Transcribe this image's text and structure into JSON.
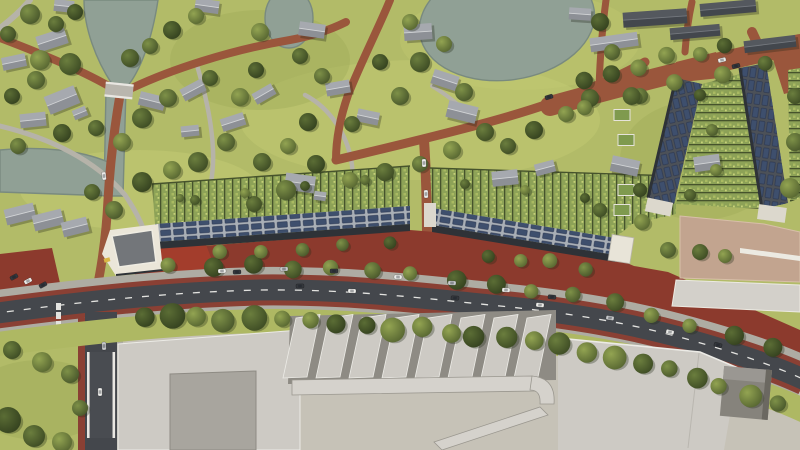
{
  "meta": {
    "description": "aerial-render-of-residential-masterplan",
    "canvas": {
      "width": 800,
      "height": 450
    }
  },
  "colors": {
    "grass": "#b2bb68",
    "grassLight": "#c3cc74",
    "grassDark": "#9dab58",
    "verge": "#aeb863",
    "water": "#90a095",
    "waterEdge": "#798a7f",
    "brick": "#9a563c",
    "brickDark": "#7e4030",
    "plaza": "#8c3a2d",
    "brightRed": "#a33d2c",
    "grayPath": "#b6b3a9",
    "asphalt": "#44474c",
    "asphaltRamp": "#494c51",
    "cycleRed": "#8a4034",
    "sidewalk": "#aeaca3",
    "dash": "#e3e3e0",
    "roofRidge": "#cfd1d4",
    "terRoof": "#a9afb6",
    "terRoofDark": "#4c5158",
    "solar": "#3e4f6d",
    "facade": "#2e3237",
    "gardenA": "#8da257",
    "gardenB": "#a9ba62",
    "hedge": "#46532c",
    "indRoof": "#cdcac4",
    "indRoofDark": "#a8a59e",
    "indShadow": "#8e8b84",
    "yard": "#c6c2b7",
    "ledge": "#d5d2cc",
    "parapet": "#ecebe6",
    "tanRoof": "#c2a48f",
    "whiteBld": "#ebe6d9",
    "wallWhite": "#e9e7e2",
    "accentYellow": "#d9b544",
    "greenRoof": "#7f9a4e"
  },
  "scene": {
    "tree_palette": [
      [
        "#93a452",
        "#556430"
      ],
      [
        "#7e9148",
        "#47552a"
      ],
      [
        "#6b7e3e",
        "#3c4a23"
      ],
      [
        "#5b6d35",
        "#33401e"
      ]
    ],
    "car_palette": [
      "#ebebe8",
      "#34373c",
      "#c6c8ca",
      "#6b87a8"
    ],
    "house_tones": [
      [
        "#a6a9af",
        "#8d9096",
        "#d2d4d6"
      ],
      [
        "#54585e",
        "#43474d",
        "#74787e"
      ]
    ],
    "houses": [
      [
        52,
        40,
        30,
        16,
        -18,
        0
      ],
      [
        14,
        62,
        24,
        13,
        -12,
        0
      ],
      [
        62,
        100,
        32,
        19,
        -22,
        0
      ],
      [
        80,
        113,
        14,
        10,
        -22,
        0
      ],
      [
        152,
        101,
        26,
        14,
        14,
        0
      ],
      [
        33,
        120,
        26,
        14,
        -6,
        0
      ],
      [
        64,
        6,
        20,
        12,
        6,
        0
      ],
      [
        207,
        6,
        24,
        13,
        8,
        0
      ],
      [
        193,
        90,
        24,
        13,
        -28,
        0
      ],
      [
        233,
        122,
        24,
        13,
        -18,
        0
      ],
      [
        190,
        131,
        18,
        11,
        -6,
        0
      ],
      [
        264,
        94,
        22,
        12,
        -30,
        0
      ],
      [
        312,
        30,
        26,
        14,
        8,
        0
      ],
      [
        338,
        88,
        24,
        13,
        -10,
        0
      ],
      [
        368,
        117,
        22,
        13,
        12,
        0
      ],
      [
        418,
        32,
        28,
        16,
        -4,
        0
      ],
      [
        445,
        80,
        26,
        15,
        18,
        0
      ],
      [
        462,
        112,
        30,
        17,
        14,
        0
      ],
      [
        300,
        183,
        30,
        17,
        8,
        0
      ],
      [
        320,
        196,
        12,
        9,
        8,
        0
      ],
      [
        505,
        178,
        26,
        15,
        -6,
        0
      ],
      [
        545,
        168,
        20,
        12,
        -15,
        0
      ],
      [
        625,
        166,
        28,
        16,
        12,
        0
      ],
      [
        707,
        163,
        26,
        15,
        -8,
        0
      ],
      [
        20,
        214,
        30,
        16,
        -14,
        0
      ],
      [
        48,
        220,
        30,
        16,
        -14,
        0
      ],
      [
        75,
        227,
        26,
        15,
        -14,
        0
      ],
      [
        614,
        42,
        48,
        14,
        -8,
        0
      ],
      [
        655,
        18,
        64,
        15,
        -4,
        1
      ],
      [
        728,
        8,
        56,
        13,
        -5,
        1
      ],
      [
        695,
        32,
        50,
        12,
        -5,
        1
      ],
      [
        580,
        14,
        22,
        12,
        4,
        0
      ],
      [
        770,
        44,
        52,
        12,
        -7,
        1
      ]
    ],
    "trees": [
      [
        30,
        14,
        10,
        1
      ],
      [
        56,
        24,
        8,
        2
      ],
      [
        75,
        12,
        8,
        3
      ],
      [
        8,
        34,
        8,
        2
      ],
      [
        40,
        60,
        10,
        0
      ],
      [
        70,
        64,
        11,
        2
      ],
      [
        36,
        80,
        9,
        1
      ],
      [
        12,
        96,
        8,
        3
      ],
      [
        130,
        58,
        9,
        2
      ],
      [
        150,
        46,
        8,
        1
      ],
      [
        172,
        30,
        9,
        3
      ],
      [
        196,
        16,
        8,
        0
      ],
      [
        142,
        118,
        10,
        2
      ],
      [
        168,
        98,
        9,
        1
      ],
      [
        122,
        142,
        9,
        0
      ],
      [
        96,
        128,
        8,
        2
      ],
      [
        62,
        133,
        9,
        3
      ],
      [
        18,
        146,
        8,
        1
      ],
      [
        210,
        78,
        8,
        2
      ],
      [
        240,
        97,
        9,
        0
      ],
      [
        256,
        70,
        8,
        3
      ],
      [
        226,
        142,
        9,
        1
      ],
      [
        198,
        162,
        10,
        2
      ],
      [
        172,
        170,
        9,
        0
      ],
      [
        142,
        182,
        10,
        3
      ],
      [
        114,
        210,
        9,
        1
      ],
      [
        92,
        192,
        8,
        2
      ],
      [
        262,
        162,
        9,
        2
      ],
      [
        288,
        146,
        8,
        0
      ],
      [
        308,
        122,
        9,
        3
      ],
      [
        322,
        76,
        8,
        1
      ],
      [
        300,
        56,
        8,
        2
      ],
      [
        260,
        32,
        9,
        0
      ],
      [
        352,
        124,
        8,
        2
      ],
      [
        400,
        96,
        9,
        1
      ],
      [
        380,
        62,
        8,
        3
      ],
      [
        410,
        22,
        8,
        0
      ],
      [
        420,
        62,
        10,
        2
      ],
      [
        444,
        44,
        8,
        0
      ],
      [
        464,
        92,
        9,
        1
      ],
      [
        485,
        132,
        9,
        2
      ],
      [
        452,
        150,
        9,
        0
      ],
      [
        420,
        164,
        8,
        1
      ],
      [
        385,
        172,
        9,
        2
      ],
      [
        350,
        180,
        8,
        0
      ],
      [
        316,
        164,
        9,
        3
      ],
      [
        286,
        190,
        10,
        1
      ],
      [
        254,
        204,
        8,
        2
      ],
      [
        600,
        22,
        9,
        3
      ],
      [
        612,
        52,
        8,
        1
      ],
      [
        590,
        98,
        9,
        2
      ],
      [
        566,
        114,
        8,
        0
      ],
      [
        534,
        130,
        9,
        3
      ],
      [
        508,
        146,
        8,
        2
      ],
      [
        640,
        96,
        8,
        1
      ],
      [
        642,
        222,
        8,
        0
      ],
      [
        668,
        250,
        8,
        1
      ],
      [
        700,
        252,
        8,
        2
      ],
      [
        725,
        256,
        7,
        0
      ],
      [
        795,
        96,
        8,
        2
      ],
      [
        795,
        142,
        9,
        1
      ],
      [
        790,
        188,
        10,
        0
      ],
      [
        640,
        190,
        7,
        3
      ],
      [
        600,
        210,
        7,
        2
      ],
      [
        12,
        350,
        9,
        2
      ],
      [
        42,
        362,
        10,
        0
      ],
      [
        70,
        374,
        9,
        1
      ],
      [
        8,
        420,
        13,
        3
      ],
      [
        34,
        436,
        11,
        2
      ],
      [
        62,
        442,
        10,
        0
      ],
      [
        80,
        408,
        8,
        1
      ],
      [
        195,
        200,
        5,
        2
      ],
      [
        245,
        193,
        5,
        0
      ],
      [
        305,
        186,
        5,
        3
      ],
      [
        365,
        180,
        5,
        1
      ],
      [
        465,
        184,
        5,
        2
      ],
      [
        525,
        190,
        5,
        0
      ],
      [
        585,
        198,
        5,
        3
      ],
      [
        180,
        198,
        4,
        1
      ],
      [
        690,
        195,
        6,
        2
      ],
      [
        712,
        130,
        6,
        1
      ],
      [
        716,
        170,
        6,
        0
      ],
      [
        700,
        95,
        6,
        3
      ]
    ],
    "tree_rows": [
      {
        "pts": [
          [
            150,
            268
          ],
          [
            260,
            267
          ],
          [
            370,
            272
          ],
          [
            480,
            282
          ],
          [
            580,
            295
          ],
          [
            660,
            315
          ],
          [
            730,
            334
          ],
          [
            790,
            352
          ]
        ],
        "n": 16,
        "r0": 7,
        "r1": 10
      },
      {
        "pts": [
          [
            128,
            316
          ],
          [
            230,
            318
          ],
          [
            330,
            322
          ],
          [
            430,
            330
          ],
          [
            530,
            341
          ],
          [
            610,
            354
          ],
          [
            690,
            375
          ],
          [
            788,
            408
          ]
        ],
        "n": 24,
        "r0": 8,
        "r1": 13
      },
      {
        "pts": [
          [
            570,
            86
          ],
          [
            650,
            62
          ],
          [
            740,
            42
          ]
        ],
        "n": 6,
        "r0": 7,
        "r1": 9
      },
      {
        "pts": [
          [
            560,
            112
          ],
          [
            640,
            92
          ],
          [
            720,
            72
          ],
          [
            790,
            56
          ]
        ],
        "n": 5,
        "r0": 7,
        "r1": 9
      },
      {
        "pts": [
          [
            200,
            252
          ],
          [
            280,
            248
          ],
          [
            360,
            244
          ],
          [
            408,
            240
          ]
        ],
        "n": 5,
        "r0": 6,
        "r1": 8
      },
      {
        "pts": [
          [
            470,
            252
          ],
          [
            540,
            262
          ],
          [
            600,
            270
          ]
        ],
        "n": 4,
        "r0": 6,
        "r1": 8
      }
    ],
    "cars": [
      [
        300,
        286,
        -1,
        1
      ],
      [
        352,
        291,
        1,
        0
      ],
      [
        455,
        298,
        3,
        1
      ],
      [
        540,
        305,
        5,
        0
      ],
      [
        610,
        318,
        9,
        2
      ],
      [
        670,
        332,
        13,
        0
      ],
      [
        718,
        345,
        16,
        1
      ],
      [
        222,
        271,
        -2,
        0
      ],
      [
        237,
        272,
        -2,
        1
      ],
      [
        284,
        269,
        -1,
        2
      ],
      [
        334,
        271,
        0,
        1
      ],
      [
        398,
        277,
        1,
        0
      ],
      [
        452,
        283,
        2,
        2
      ],
      [
        506,
        290,
        3,
        0
      ],
      [
        552,
        297,
        5,
        1
      ],
      [
        424,
        163,
        88,
        0
      ],
      [
        426,
        194,
        88,
        0
      ],
      [
        549,
        97,
        -17,
        1
      ],
      [
        722,
        60,
        -14,
        0
      ],
      [
        736,
        66,
        -14,
        1
      ],
      [
        104,
        176,
        84,
        0
      ],
      [
        100,
        392,
        90,
        0
      ],
      [
        104,
        346,
        88,
        2
      ],
      [
        14,
        277,
        -28,
        1
      ],
      [
        28,
        281,
        -28,
        0
      ],
      [
        43,
        285,
        -28,
        1
      ]
    ],
    "sawtooth": {
      "x0": 296,
      "dx": 33,
      "n": 8,
      "topY": 318,
      "topY2": 314.5,
      "botY": 377,
      "lean": 13,
      "w": 24
    },
    "green_boxes": [
      [
        622,
        115
      ],
      [
        626,
        140
      ],
      [
        622,
        165
      ],
      [
        626,
        190
      ],
      [
        622,
        210
      ]
    ]
  }
}
